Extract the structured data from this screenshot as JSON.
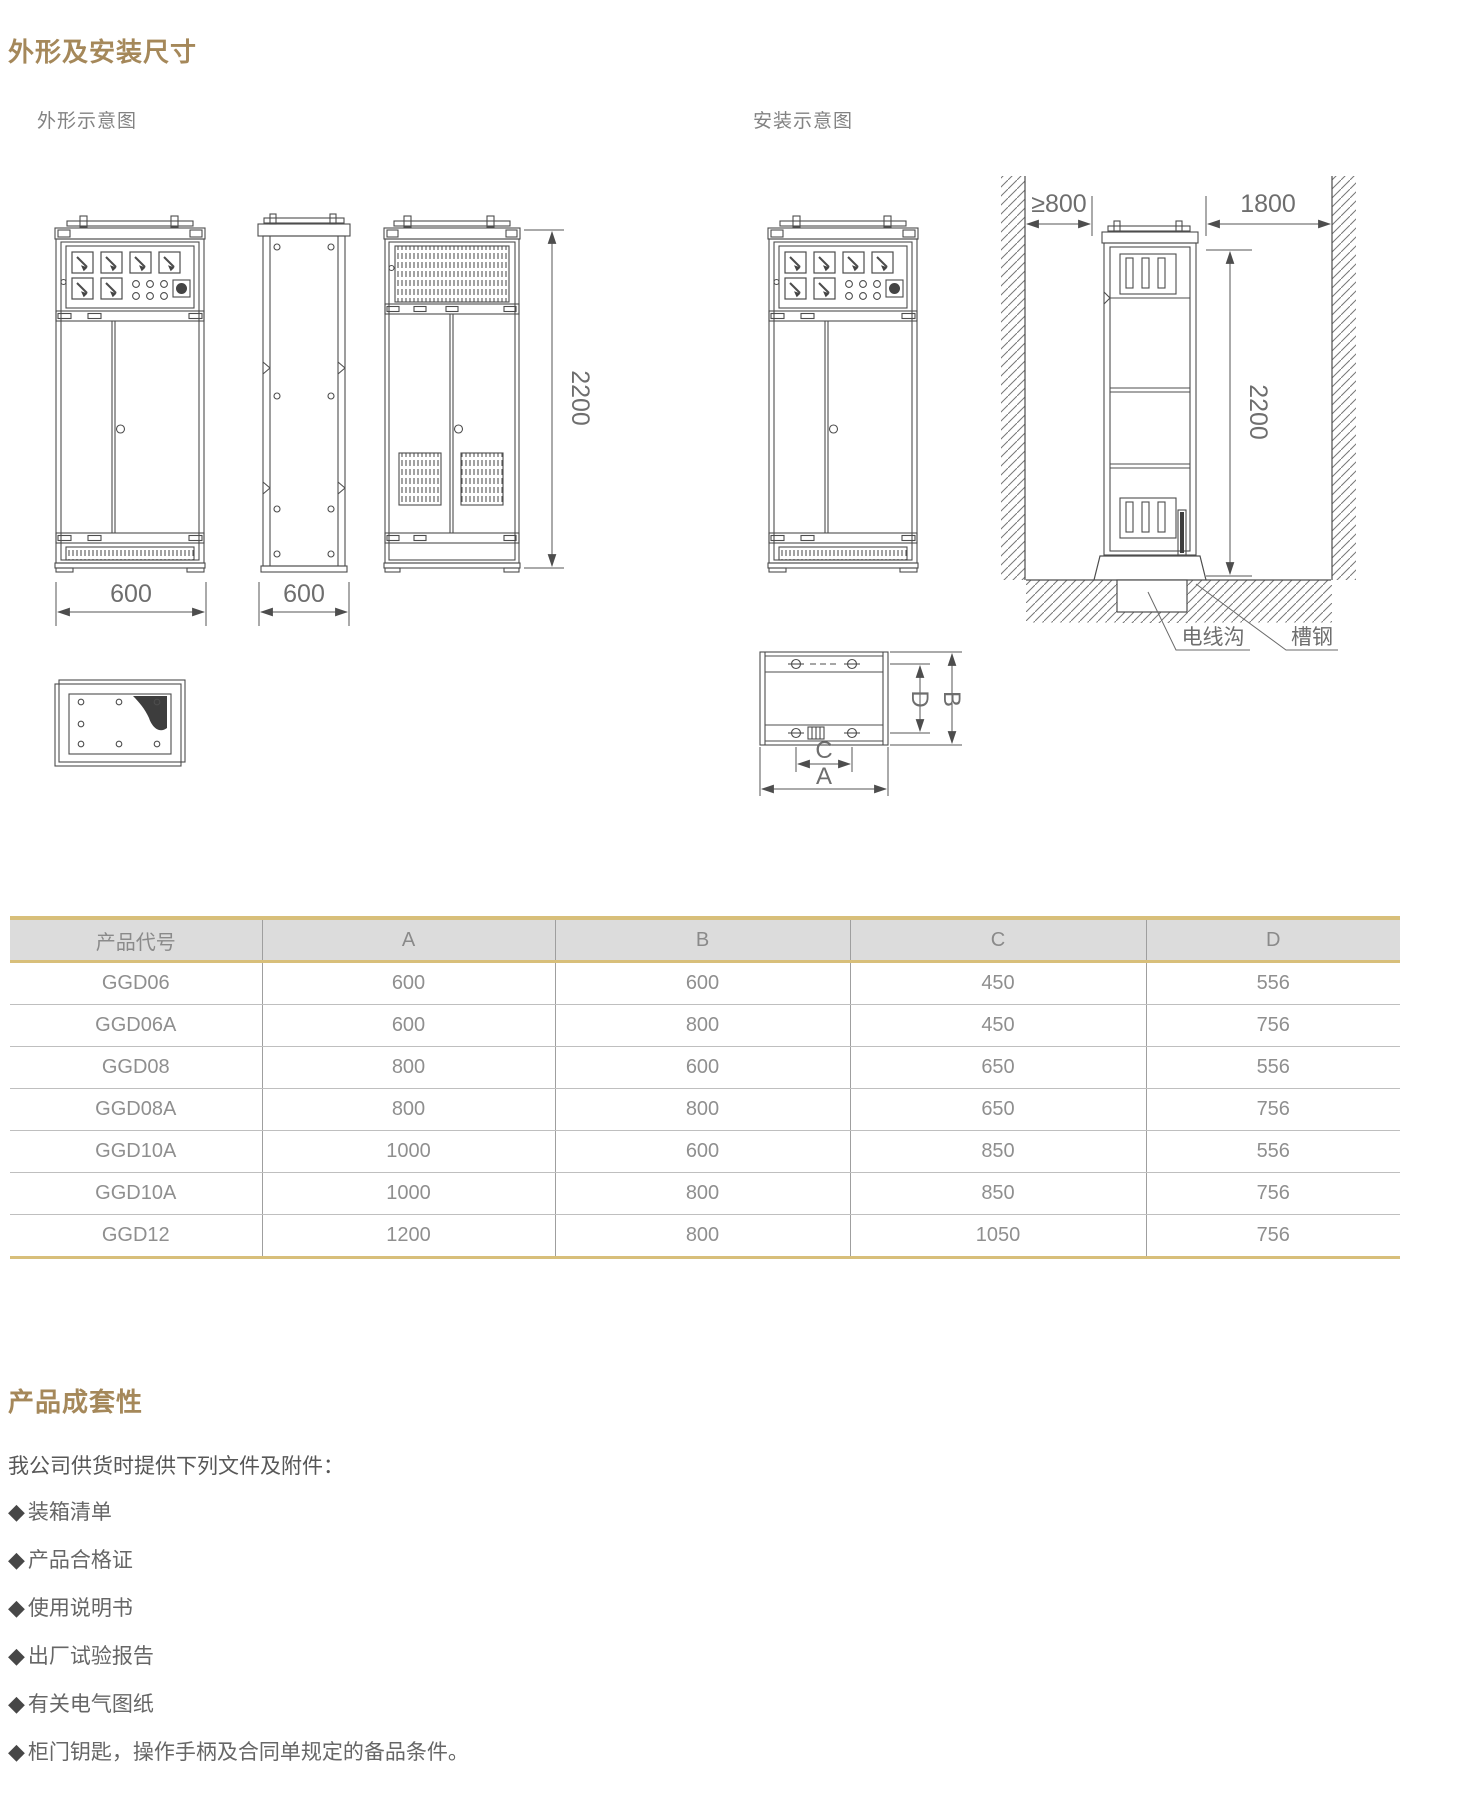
{
  "page": {
    "section1_title": "外形及安装尺寸",
    "outline_label": "外形示意图",
    "install_label": "安装示意图"
  },
  "drawing": {
    "outline_front_width": "600",
    "outline_side_depth": "600",
    "outline_height": "2200",
    "install_rear_clearance": "≥800",
    "install_front_clearance": "1800",
    "install_height": "2200",
    "cable_trench_label": "电线沟",
    "channel_steel_label": "槽钢",
    "dim_a_label": "A",
    "dim_b_label": "B",
    "dim_c_label": "C",
    "dim_d_label": "D"
  },
  "table": {
    "headers": [
      "产品代号",
      "A",
      "B",
      "C",
      "D"
    ],
    "rows": [
      {
        "code": "GGD06",
        "a": "600",
        "b": "600",
        "c": "450",
        "d": "556"
      },
      {
        "code": "GGD06A",
        "a": "600",
        "b": "800",
        "c": "450",
        "d": "756"
      },
      {
        "code": "GGD08",
        "a": "800",
        "b": "600",
        "c": "650",
        "d": "556"
      },
      {
        "code": "GGD08A",
        "a": "800",
        "b": "800",
        "c": "650",
        "d": "756"
      },
      {
        "code": "GGD10A",
        "a": "1000",
        "b": "600",
        "c": "850",
        "d": "556"
      },
      {
        "code": "GGD10A",
        "a": "1000",
        "b": "800",
        "c": "850",
        "d": "756"
      },
      {
        "code": "GGD12",
        "a": "1200",
        "b": "800",
        "c": "1050",
        "d": "756"
      }
    ]
  },
  "kit": {
    "title": "产品成套性",
    "intro": "我公司供货时提供下列文件及附件：",
    "bullet": "◆",
    "items": [
      "装箱清单",
      "产品合格证",
      "使用说明书",
      "出厂试验报告",
      "有关电气图纸",
      "柜门钥匙，操作手柄及合同单规定的备品条件。"
    ]
  },
  "colors": {
    "accent": "#a5885a",
    "table_gold": "#d8bf7a",
    "header_bg": "#dcdcdc"
  }
}
